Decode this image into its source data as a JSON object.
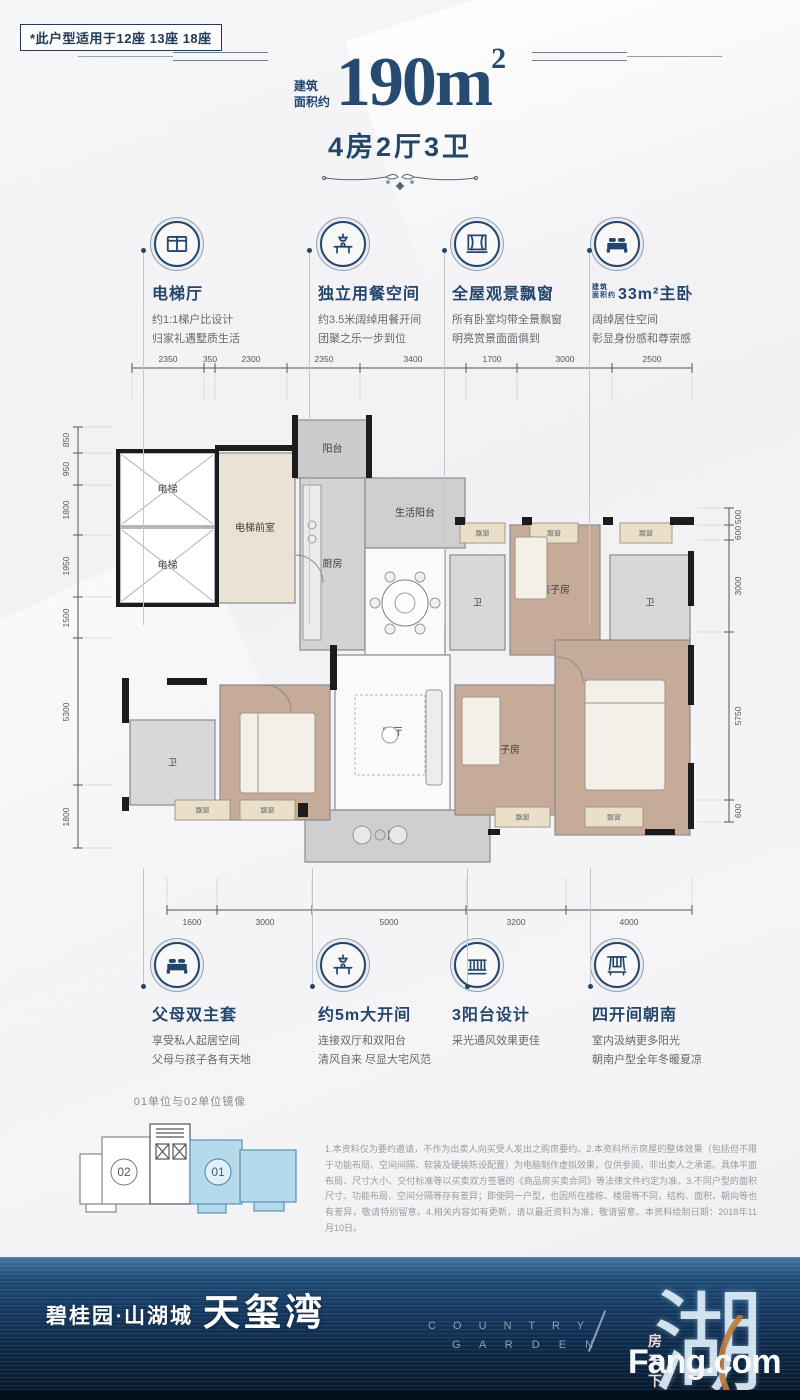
{
  "badge": {
    "text": "*此户型适用于12座 13座 18座"
  },
  "header": {
    "area_prefix_line1": "建筑",
    "area_prefix_line2": "面积约",
    "area_value": "190m",
    "area_sup": "2",
    "subtitle": "4房2厅3卫"
  },
  "features_top": [
    {
      "icon": "elevator-icon",
      "title": "电梯厅",
      "desc1": "约1:1梯户比设计",
      "desc2": "归家礼遇墅质生活"
    },
    {
      "icon": "dining-icon",
      "title": "独立用餐空间",
      "desc1": "约3.5米阔绰用餐开间",
      "desc2": "团聚之乐一步到位"
    },
    {
      "icon": "baywindow-icon",
      "title": "全屋观景飘窗",
      "desc1": "所有卧室均带全景飘窗",
      "desc2": "明亮赏景面面俱到"
    },
    {
      "icon": "bed-icon",
      "title": "33m²主卧",
      "title_prefix1": "建筑",
      "title_prefix2": "面积约",
      "desc1": "阔绰居住空间",
      "desc2": "彰显身份感和尊崇感"
    }
  ],
  "features_bottom": [
    {
      "icon": "bed-icon",
      "title": "父母双主套",
      "desc1": "享受私人起居空间",
      "desc2": "父母与孩子各有天地"
    },
    {
      "icon": "dining-icon",
      "title": "约5m大开间",
      "desc1": "连接双厅和双阳台",
      "desc2": "清风自来 尽显大宅风范"
    },
    {
      "icon": "balcony-icon",
      "title": "3阳台设计",
      "desc1": "采光通风效果更佳",
      "desc2": ""
    },
    {
      "icon": "south-window-icon",
      "title": "四开间朝南",
      "desc1": "室内汲纳更多阳光",
      "desc2": "朝南户型全年冬暖夏凉"
    }
  ],
  "floorplan": {
    "dims_top": [
      {
        "v": "2350",
        "x": 108
      },
      {
        "v": "350",
        "x": 150
      },
      {
        "v": "2300",
        "x": 191
      },
      {
        "v": "2350",
        "x": 264
      },
      {
        "v": "3400",
        "x": 353
      },
      {
        "v": "1700",
        "x": 432
      },
      {
        "v": "3000",
        "x": 505
      },
      {
        "v": "2500",
        "x": 592
      }
    ],
    "ticks_top": [
      72,
      144,
      155,
      227,
      300,
      406,
      457,
      552,
      632
    ],
    "dims_bottom": [
      {
        "v": "1600",
        "x": 132
      },
      {
        "v": "3000",
        "x": 205
      },
      {
        "v": "5000",
        "x": 329
      },
      {
        "v": "3200",
        "x": 456
      },
      {
        "v": "4000",
        "x": 569
      }
    ],
    "ticks_bottom": [
      107,
      157,
      252,
      406,
      506,
      632
    ],
    "dims_left": [
      {
        "v": "850",
        "y": 95
      },
      {
        "v": "950",
        "y": 124
      },
      {
        "v": "1800",
        "y": 165
      },
      {
        "v": "1950",
        "y": 221
      },
      {
        "v": "1500",
        "y": 273
      },
      {
        "v": "5300",
        "y": 367
      },
      {
        "v": "1800",
        "y": 472
      }
    ],
    "ticks_left": [
      82,
      108,
      140,
      190,
      252,
      293,
      440,
      503
    ],
    "dims_right": [
      {
        "v": "500",
        "y": 172
      },
      {
        "v": "600",
        "y": 188
      },
      {
        "v": "3000",
        "y": 241
      },
      {
        "v": "5750",
        "y": 371
      },
      {
        "v": "600",
        "y": 466
      }
    ],
    "ticks_right": [
      163,
      180,
      195,
      287,
      455,
      477
    ],
    "rooms": [
      {
        "label": "电梯",
        "x": 60,
        "y": 108,
        "w": 95,
        "h": 73,
        "fill": "#ffffff",
        "type": "elevator"
      },
      {
        "label": "电梯",
        "x": 60,
        "y": 183,
        "w": 95,
        "h": 75,
        "fill": "#ffffff",
        "type": "elevator"
      },
      {
        "label": "电梯前室",
        "x": 155,
        "y": 108,
        "w": 80,
        "h": 150,
        "fill": "#eae2d4"
      },
      {
        "label": "阳台",
        "x": 235,
        "y": 75,
        "w": 75,
        "h": 58,
        "fill": "#cccccf"
      },
      {
        "label": "厨房",
        "x": 240,
        "y": 133,
        "w": 65,
        "h": 172,
        "fill": "#d3d3d6"
      },
      {
        "label": "生活阳台",
        "x": 305,
        "y": 133,
        "w": 100,
        "h": 70,
        "fill": "#cfcfd2"
      },
      {
        "label": "餐厅",
        "x": 305,
        "y": 203,
        "w": 80,
        "h": 107,
        "fill": "#fafafa"
      },
      {
        "label": "客厅",
        "x": 275,
        "y": 310,
        "w": 115,
        "h": 155,
        "fill": "#fafafa"
      },
      {
        "label": "阳台",
        "x": 245,
        "y": 465,
        "w": 185,
        "h": 52,
        "fill": "#cfcfd2"
      },
      {
        "label": "父母房",
        "x": 160,
        "y": 340,
        "w": 110,
        "h": 135,
        "fill": "#c6ab98"
      },
      {
        "label": "卫",
        "x": 70,
        "y": 375,
        "w": 85,
        "h": 85,
        "fill": "#d8d8db"
      },
      {
        "label": "卫",
        "x": 390,
        "y": 210,
        "w": 55,
        "h": 95,
        "fill": "#d8d8db"
      },
      {
        "label": "孩子房",
        "x": 450,
        "y": 180,
        "w": 90,
        "h": 130,
        "fill": "#c6ab98"
      },
      {
        "label": "卫",
        "x": 550,
        "y": 210,
        "w": 80,
        "h": 95,
        "fill": "#d8d8db"
      },
      {
        "label": "主人房",
        "x": 495,
        "y": 295,
        "w": 135,
        "h": 195,
        "fill": "#c6ab98"
      },
      {
        "label": "孩子房",
        "x": 395,
        "y": 340,
        "w": 100,
        "h": 130,
        "fill": "#c6ab98"
      }
    ],
    "windows": [
      {
        "label": "飘窗",
        "x": 400,
        "y": 178,
        "w": 45,
        "h": 20
      },
      {
        "label": "飘窗",
        "x": 470,
        "y": 178,
        "w": 48,
        "h": 20
      },
      {
        "label": "飘窗",
        "x": 560,
        "y": 178,
        "w": 52,
        "h": 20
      },
      {
        "label": "飘窗",
        "x": 115,
        "y": 455,
        "w": 55,
        "h": 20
      },
      {
        "label": "飘窗",
        "x": 180,
        "y": 455,
        "w": 55,
        "h": 20
      },
      {
        "label": "飘窗",
        "x": 435,
        "y": 462,
        "w": 55,
        "h": 20
      },
      {
        "label": "飘窗",
        "x": 525,
        "y": 462,
        "w": 58,
        "h": 20
      }
    ]
  },
  "keyplan": {
    "title": "01单位与02单位镜像",
    "unit_left": "02",
    "unit_right": "01"
  },
  "disclaimer": "1.本资料仅为要约邀请，不作为出卖人向买受人发出之购房要约。2.本资料所示房屋的整体效果（包括但不限于功能布局、空间间隔、软装及硬装陈设配置）为电脑制作虚拟效果，仅供参阅，非出卖人之承诺。具体平面布局、尺寸大小、交付标准等以买卖双方签署的《商品房买卖合同》等法律文件约定为准。3.不同户型的面积尺寸、功能布局、空间分隔等存有差异；即使同一户型，也因所在楼栋、楼层等不同，结构、面积、朝向等也有差异，敬请特别留意。4.相关内容如有更新，请以最近资料为准，敬请留意。本资料绘制日期：2018年11月10日。",
  "banner": {
    "brand": "碧桂园·山湖城",
    "project": "天玺湾",
    "english_line1": "C O U N T R Y",
    "english_line2": "G A R D E N",
    "lake_glyph": "湖",
    "watermark_cn": "房天下",
    "watermark_en": "Fang.com"
  }
}
